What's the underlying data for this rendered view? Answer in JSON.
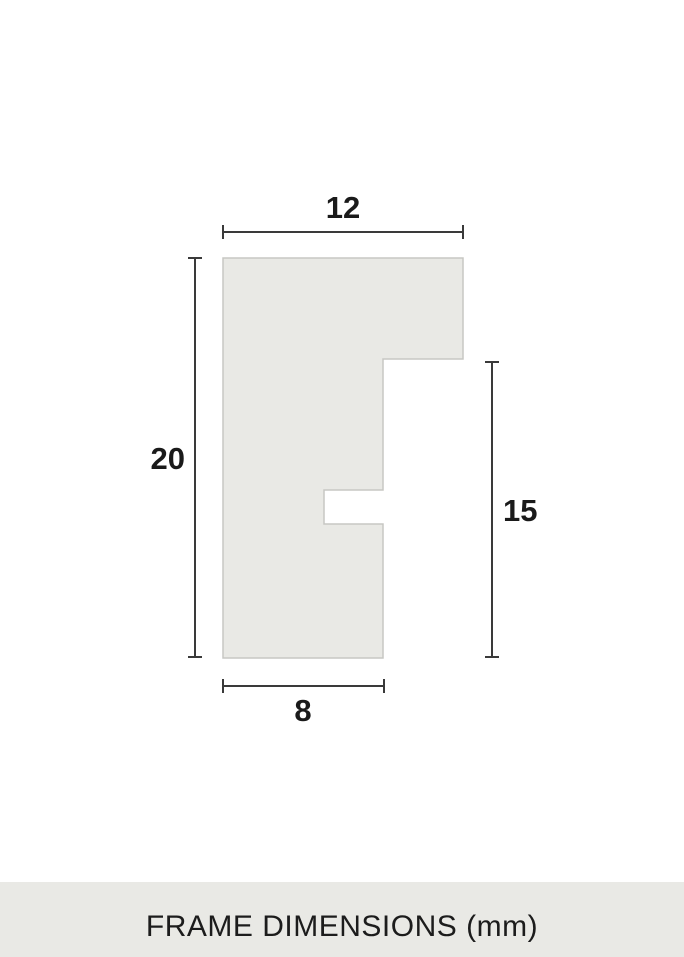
{
  "diagram": {
    "type": "frame-profile-cross-section",
    "profile": {
      "fill": "#e9e9e5",
      "stroke": "#c7c7c3"
    },
    "dimension_line_color": "#3a3a3a",
    "label_color": "#1a1a1a",
    "dimensions": {
      "top_width": "12",
      "left_height": "20",
      "right_height": "15",
      "bottom_width": "8"
    },
    "unit": "mm"
  },
  "footer": {
    "label": "FRAME DIMENSIONS (mm)",
    "background": "#e9e9e5",
    "text_color": "#1c1c1c"
  }
}
